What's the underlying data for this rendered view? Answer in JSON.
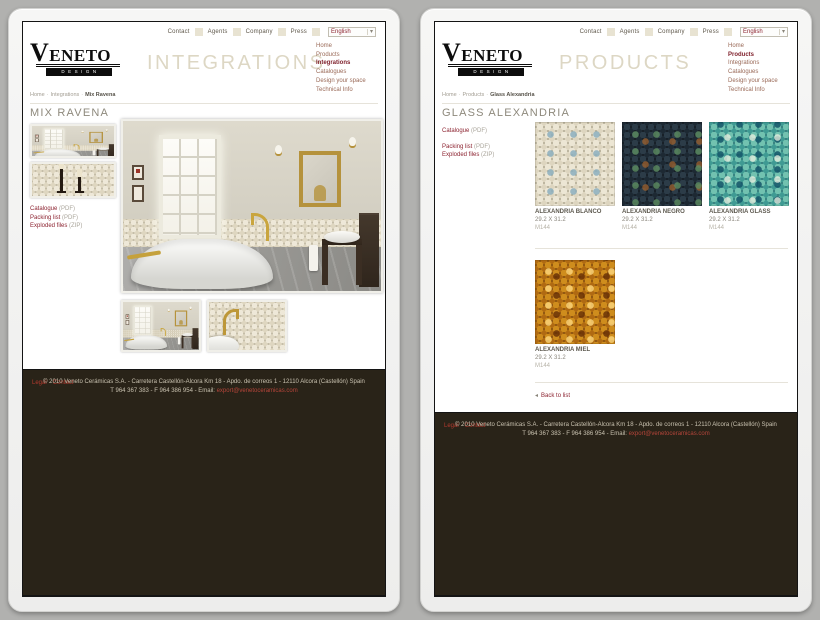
{
  "colors": {
    "accent_maroon": "#8c2330",
    "menu_link": "#9a6a58",
    "page_title_beige": "#ddd7c4",
    "nav_square_beige": "#e8e3d2",
    "footer_bg": "#292318",
    "background_gray": "#b1b1af"
  },
  "shared": {
    "logo_word": "VENETO",
    "logo_sub": "DESIGN",
    "nav": [
      "Contact",
      "Agents",
      "Company",
      "Press"
    ],
    "language_selected": "English",
    "menu": [
      "Home",
      "Products",
      "Integrations",
      "Catalogues",
      "Design your space",
      "Technical Info"
    ],
    "crumb_sep": "·",
    "doc_links": {
      "catalogue": "Catalogue",
      "catalogue_type": "(PDF)",
      "packing": "Packing list",
      "packing_type": "(PDF)",
      "exploded": "Exploded files",
      "exploded_type": "(ZIP)"
    },
    "footer": {
      "legal": "Legal",
      "dash": "-",
      "contact": "Contact",
      "copyright": "© 2010 Veneto Cerámicas S.A. - Carretera Castellón-Alcora Km 18 - Apdo. de correos 1 - 12110 Alcora (Castellón) Spain",
      "phone_line": "T 964 367 383 - F 964 386 954 - Email:",
      "email": "export@venetoceramicas.com"
    }
  },
  "left": {
    "page_title": "INTEGRATIONS",
    "breadcrumb": [
      "Home",
      "Integrations",
      "Mix Ravena"
    ],
    "heading": "MIX RAVENA"
  },
  "right": {
    "page_title": "PRODUCTS",
    "breadcrumb": [
      "Home",
      "Products",
      "Glass Alexandria"
    ],
    "heading": "GLASS ALEXANDRIA",
    "back_to_list": "Back to list",
    "products": [
      {
        "name": "ALEXANDRIA BLANCO",
        "size": "29.2 X 31.2",
        "code": "M144"
      },
      {
        "name": "ALEXANDRIA NEGRO",
        "size": "29.2 X 31.2",
        "code": "M144"
      },
      {
        "name": "ALEXANDRIA GLASS",
        "size": "29.2 X 31.2",
        "code": "M144"
      },
      {
        "name": "ALEXANDRIA MIEL",
        "size": "29.2 X 31.2",
        "code": "M144"
      }
    ]
  }
}
